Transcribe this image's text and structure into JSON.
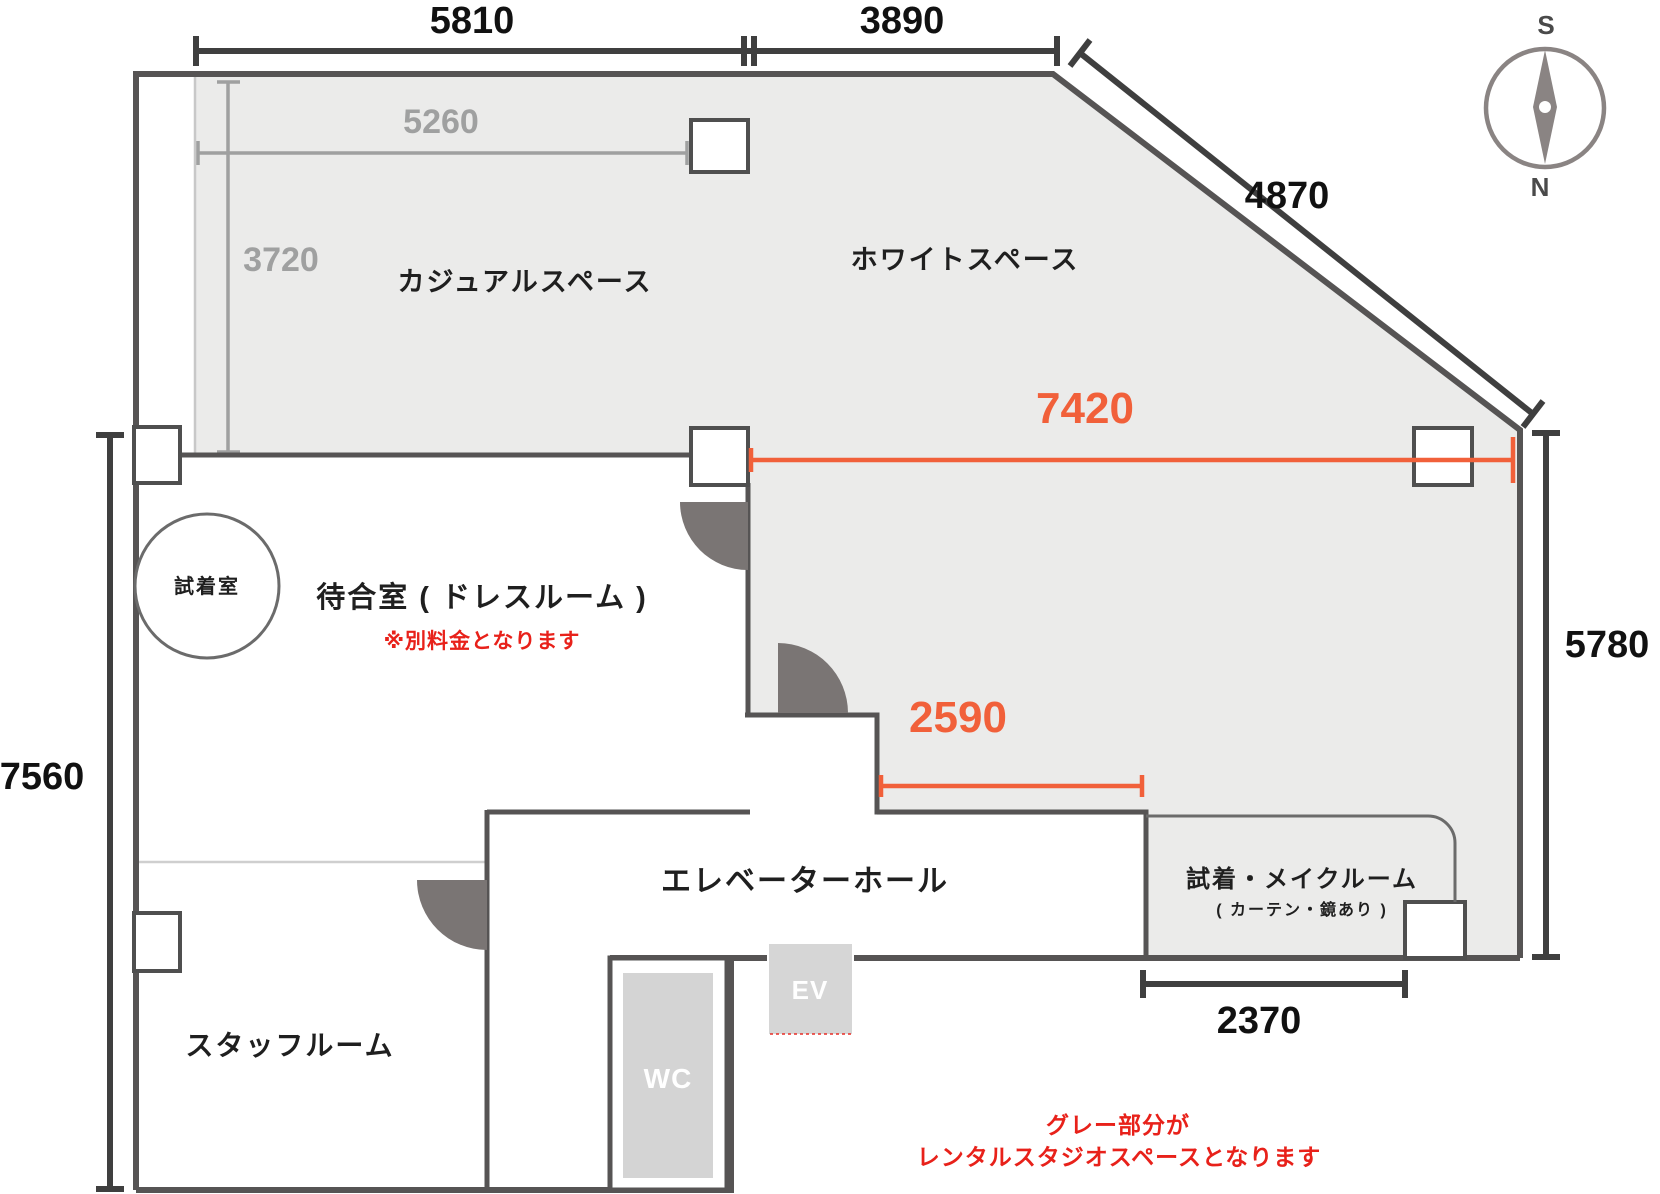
{
  "rooms": {
    "casual_space": "カジュアルスペース",
    "white_space": "ホワイトスペース",
    "waiting_room": "待合室 ( ドレスルーム )",
    "fitting_room": "試着室",
    "elevator_hall": "エレベーターホール",
    "makeup_room": "試着・メイクルーム",
    "makeup_room_sub": "( カーテン・鏡あり )",
    "staff_room": "スタッフルーム"
  },
  "blocks": {
    "elevator": "EV",
    "toilet": "WC"
  },
  "notes": {
    "waiting_room_fee": "※別料金となります",
    "legend_line1": "グレー部分が",
    "legend_line2": "レンタルスタジオスペースとなります"
  },
  "dimensions": {
    "top_width_left": "5810",
    "top_width_right": "3890",
    "diagonal_wall": "4870",
    "casual_inner_width": "5260",
    "casual_inner_height": "3720",
    "studio_width": "7420",
    "studio_inner_width": "2590",
    "right_side_height": "5780",
    "left_side_height": "7560",
    "makeup_room_width": "2370"
  },
  "compass": {
    "top": "S",
    "bottom": "N"
  },
  "colors": {
    "wall": "#565454",
    "studio_fill": "#EBEBEA",
    "door_swing": "#7A7574",
    "dimension_gray": "#9FA0A0",
    "dimension_orange": "#F1603A",
    "note_red": "#E8211A",
    "block_fill": "#D6D6D6",
    "compass_gray": "#8A8483"
  }
}
